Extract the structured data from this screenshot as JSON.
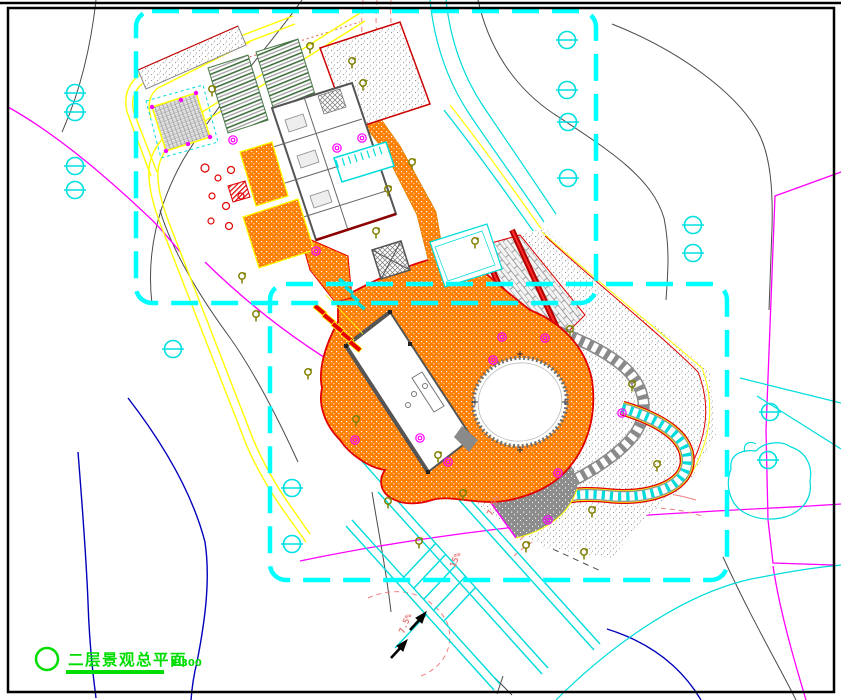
{
  "drawing": {
    "title": "二层景观总平面",
    "scale": "1:300",
    "annotations": {
      "slope_labels": [
        {
          "text": "7.5%",
          "x": 492,
          "y": 516,
          "rotation": -68
        },
        {
          "text": "15%",
          "x": 455,
          "y": 568,
          "rotation": -68
        },
        {
          "text": "7.5%",
          "x": 404,
          "y": 634,
          "rotation": -68
        }
      ]
    },
    "colors": {
      "phase_boundary": "#00ffff",
      "road_yellow": "#ffff00",
      "paving_orange": "#ff7f00",
      "water_cyan": "#00dcdc",
      "vegetation_olive": "#7f7f00",
      "contour_magenta": "#ff00ff",
      "contour_gray": "#4a4a4a",
      "contour_salmon": "#f08080",
      "stream_blue": "#0000bb",
      "accent_red": "#e00000",
      "title_green": "#00dd00"
    },
    "boundary_boxes": [
      {
        "x": 136,
        "y": 11,
        "w": 460,
        "h": 292
      },
      {
        "x": 270,
        "y": 284,
        "w": 457,
        "h": 296
      }
    ],
    "symbols": {
      "survey_markers": [
        [
          75,
          93
        ],
        [
          75,
          112
        ],
        [
          75,
          166
        ],
        [
          75,
          190
        ],
        [
          567,
          40
        ],
        [
          567,
          90
        ],
        [
          568,
          122
        ],
        [
          568,
          178
        ],
        [
          693,
          225
        ],
        [
          693,
          253
        ],
        [
          173,
          349
        ],
        [
          292,
          488
        ],
        [
          292,
          544
        ],
        [
          770,
          412
        ],
        [
          768,
          460
        ]
      ],
      "trees": [
        [
          310,
          47
        ],
        [
          352,
          62
        ],
        [
          363,
          84
        ],
        [
          212,
          90
        ],
        [
          412,
          163
        ],
        [
          388,
          190
        ],
        [
          376,
          232
        ],
        [
          242,
          277
        ],
        [
          256,
          315
        ],
        [
          308,
          373
        ],
        [
          356,
          420
        ],
        [
          570,
          330
        ],
        [
          632,
          385
        ],
        [
          657,
          465
        ],
        [
          438,
          456
        ],
        [
          463,
          494
        ],
        [
          388,
          502
        ],
        [
          419,
          542
        ],
        [
          526,
          546
        ],
        [
          584,
          553
        ],
        [
          592,
          511
        ],
        [
          475,
          242
        ]
      ],
      "shrubs": [
        [
          233,
          140
        ],
        [
          337,
          148
        ],
        [
          362,
          138
        ],
        [
          316,
          251
        ],
        [
          502,
          337
        ],
        [
          545,
          338
        ],
        [
          493,
          360
        ],
        [
          355,
          440
        ],
        [
          420,
          438
        ],
        [
          448,
          462
        ],
        [
          558,
          473
        ],
        [
          548,
          520
        ],
        [
          622,
          413
        ]
      ]
    }
  }
}
